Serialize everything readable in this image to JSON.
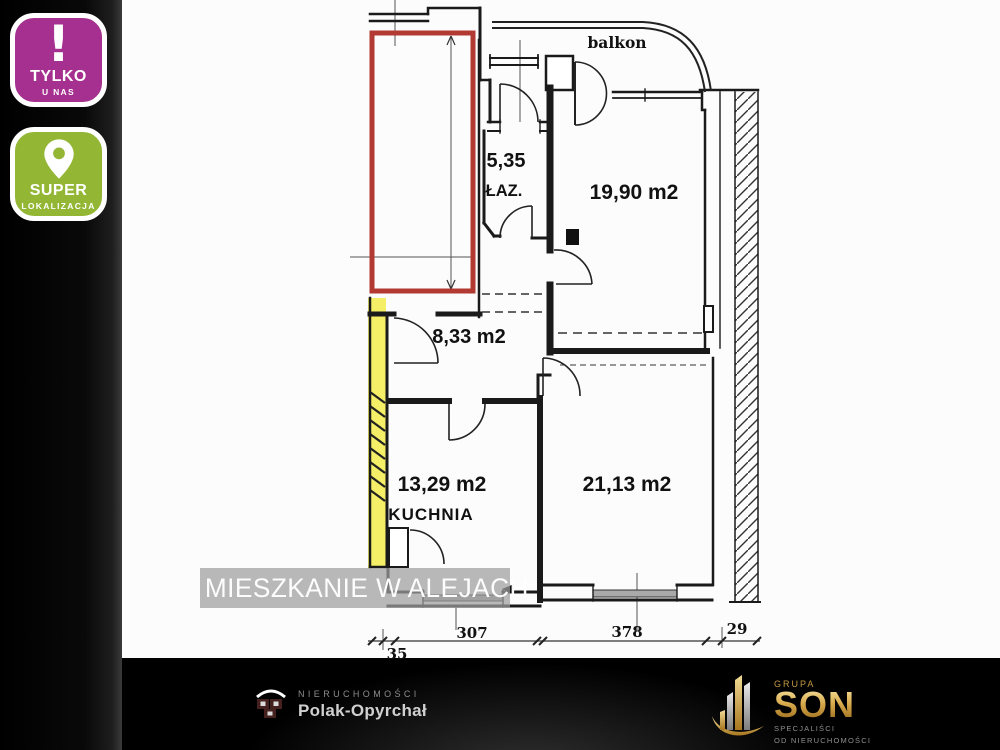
{
  "badges": [
    {
      "icon": "exclamation-icon",
      "line1": "TYLKO",
      "line2": "U NAS",
      "color": "#a5308f"
    },
    {
      "icon": "location-pin-icon",
      "line1": "SUPER",
      "line2": "LOKALIZACJA",
      "color": "#93b735"
    }
  ],
  "floorplan": {
    "balcony_label": "balkon",
    "rooms": {
      "bathroom_area": "5,35",
      "bathroom_name": "ŁAZ.",
      "room_top": "19,90 m2",
      "hallway": "8,33 m2",
      "kitchen_area": "13,29 m2",
      "kitchen_name": "KUCHNIA",
      "room_bottom": "21,13 m2"
    },
    "dimensions": [
      "35",
      "307",
      "378",
      "29"
    ],
    "highlights": {
      "red_outline": "#b23a32",
      "yellow_wall": "#f4ef67"
    }
  },
  "watermark": {
    "text": "MIESZKANIE W ALEJACH"
  },
  "footer": {
    "agency": {
      "line1": "NIERUCHOMOŚCI",
      "line2": "Polak-Opyrchał"
    },
    "group": {
      "top": "GRUPA",
      "name": "SON",
      "sub1": "SPECJALIŚCI",
      "sub2": "OD NIERUCHOMOŚCI"
    }
  }
}
